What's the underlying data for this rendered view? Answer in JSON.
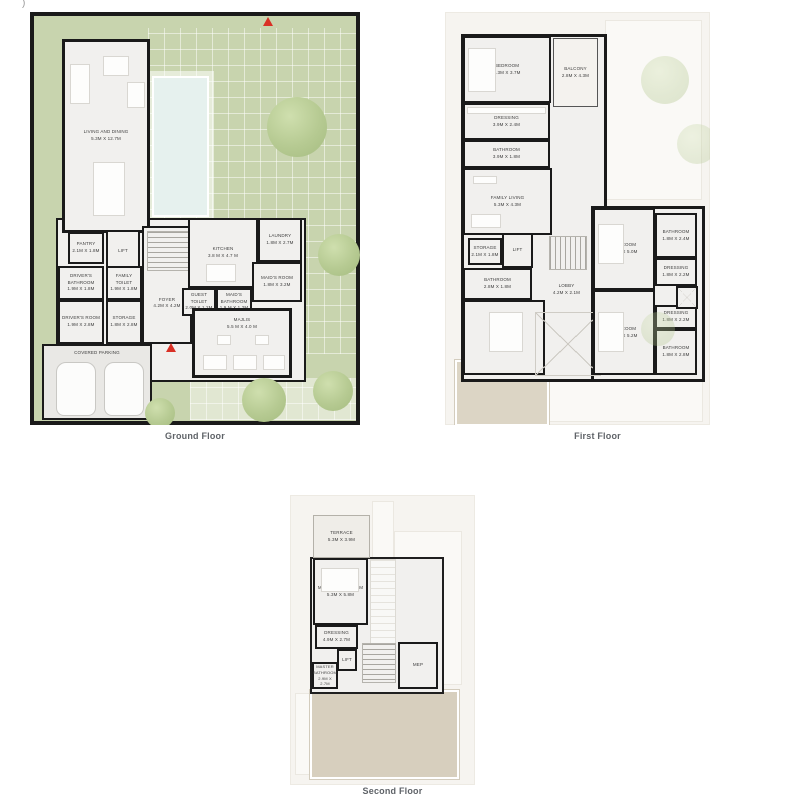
{
  "page": {
    "artifact_mark": ")",
    "colors": {
      "landscape_green": "#c8d4ae",
      "pool_blue": "#e6f1ee",
      "wall_black": "#1a1a1a",
      "room_fill": "#f1f0ee",
      "deck_beige": "#d7cfbe",
      "entry_arrow_red": "#d93025",
      "caption_gray": "#5f6368"
    }
  },
  "floors": [
    {
      "caption": "Ground Floor",
      "rooms": [
        {
          "label": "LIVING AND DINING",
          "dim": "5.3M X 12.7M"
        },
        {
          "label": "PANTRY",
          "dim": "2.1M X 1.8M"
        },
        {
          "label": "LIFT",
          "dim": ""
        },
        {
          "label": "DRIVER'S BATHROOM",
          "dim": "1.9M X 1.8M"
        },
        {
          "label": "FAMILY TOILET",
          "dim": "1.9M X 1.8M"
        },
        {
          "label": "DRIVER'S ROOM",
          "dim": "1.9M X 2.8M"
        },
        {
          "label": "STORAGE",
          "dim": "1.8M X 2.8M"
        },
        {
          "label": "FOYER",
          "dim": "4.2M X 4.2M"
        },
        {
          "label": "KITCHEN",
          "dim": "3.8 M X 4.7 M"
        },
        {
          "label": "LAUNDRY",
          "dim": "1.8M X 2.7M"
        },
        {
          "label": "MAID'S ROOM",
          "dim": "1.8M X 3.2M"
        },
        {
          "label": "GUEST TOILET",
          "dim": "2.0M X 1.2M"
        },
        {
          "label": "MAID'S BATHROOM",
          "dim": "1.9 M X 1.2M"
        },
        {
          "label": "MAJLIS",
          "dim": "5.5 M X 4.0 M"
        },
        {
          "label": "COVERED PARKING",
          "dim": ""
        }
      ]
    },
    {
      "caption": "First Floor",
      "rooms": [
        {
          "label": "BEDROOM",
          "dim": "5.3M X 3.7M"
        },
        {
          "label": "BALCONY",
          "dim": "2.8M X 4.3M"
        },
        {
          "label": "DRESSING",
          "dim": "3.9M X 2.4M"
        },
        {
          "label": "BATHROOM",
          "dim": "3.9M X 1.8M"
        },
        {
          "label": "FAMILY LIVING",
          "dim": "5.3M X 4.3M"
        },
        {
          "label": "STORAGE",
          "dim": "2.1M X 1.8M"
        },
        {
          "label": "LIFT",
          "dim": ""
        },
        {
          "label": "BATHROOM",
          "dim": "2.8M X 1.8M"
        },
        {
          "label": "LOBBY",
          "dim": "4.2M X 2.1M"
        },
        {
          "label": "BEDROOM",
          "dim": "3.9M X 4.9M"
        },
        {
          "label": "BEDROOM",
          "dim": "3.7M X 5.0M"
        },
        {
          "label": "BATHROOM",
          "dim": "1.8M X 2.4M"
        },
        {
          "label": "DRESSING",
          "dim": "1.8M X 2.2M"
        },
        {
          "label": "DRESSING",
          "dim": "1.8M X 2.2M"
        },
        {
          "label": "BEDROOM",
          "dim": "3.7M X 5.2M"
        },
        {
          "label": "BATHROOM",
          "dim": "1.8M X 2.8M"
        }
      ]
    },
    {
      "caption": "Second Floor",
      "rooms": [
        {
          "label": "TERRACE",
          "dim": "5.3M X 3.9M"
        },
        {
          "label": "MASTER BEDROOM",
          "dim": "5.3M X 5.8M"
        },
        {
          "label": "DRESSING",
          "dim": "4.9M X 2.7M"
        },
        {
          "label": "LIFT",
          "dim": ""
        },
        {
          "label": "MASTER BATHROOM",
          "dim": "2.9M X 2.7M"
        },
        {
          "label": "MEP",
          "dim": ""
        }
      ]
    }
  ]
}
